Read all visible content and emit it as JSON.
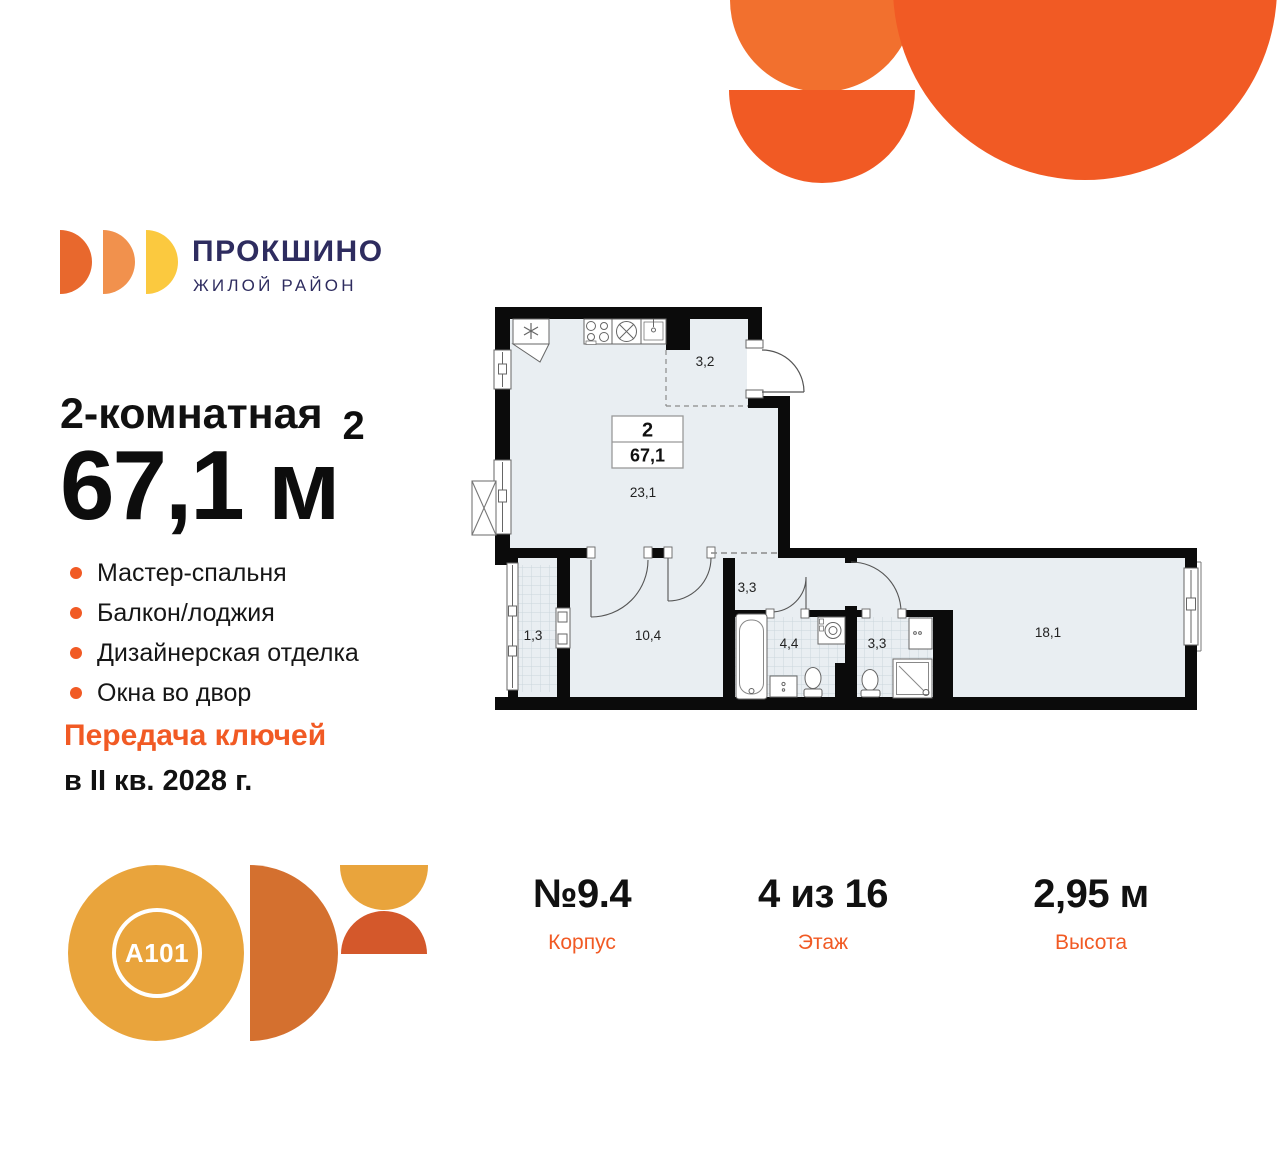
{
  "brand": {
    "name": "ПРОКШИНО",
    "tagline": "ЖИЛОЙ РАЙОН",
    "developer_logo_text": "A101"
  },
  "colors": {
    "brand_orange": "#F15A24",
    "brand_orange_light": "#F2702E",
    "brand_navy": "#2E2C5F",
    "amber": "#E9A43C",
    "burnt_orange": "#D4702F",
    "rust": "#D4582B",
    "plan_floor": "#E9EEF2",
    "plan_wall": "#0b0b0b"
  },
  "listing": {
    "type_title": "2-комнатная",
    "area_text": "67,1 м",
    "area_sup": "2",
    "features": [
      "Мастер-спальня",
      "Балкон/лоджия",
      "Дизайнерская отделка",
      "Окна во двор"
    ],
    "handover_line1": "Передача ключей",
    "handover_line2": "в II кв. 2028 г."
  },
  "plan": {
    "info_box": {
      "rooms": "2",
      "area": "67,1"
    },
    "rooms": {
      "entry_hall": "3,2",
      "kitchen_living": "23,1",
      "corridor": "3,3",
      "balcony": "1,3",
      "bedroom": "10,4",
      "bathroom": "4,4",
      "shower_room": "3,3",
      "master_bedroom": "18,1"
    }
  },
  "stats": {
    "building": {
      "value": "№9.4",
      "label": "Корпус"
    },
    "floor": {
      "value": "4 из 16",
      "label": "Этаж"
    },
    "height": {
      "value": "2,95 м",
      "label": "Высота"
    }
  }
}
